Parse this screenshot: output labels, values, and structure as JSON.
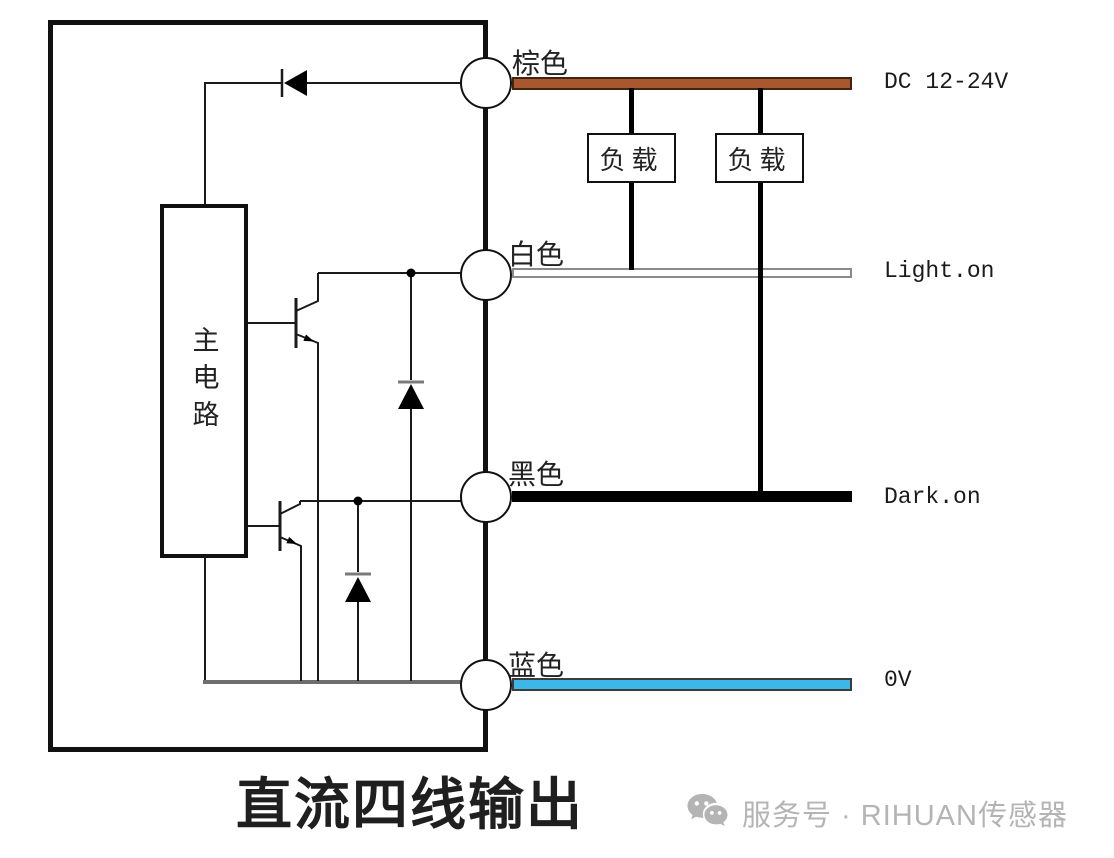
{
  "title": "直流四线输出",
  "sensor": {
    "main_circuit_label": "主电路"
  },
  "loads": [
    {
      "label": "负载"
    },
    {
      "label": "负载"
    }
  ],
  "terminals": [
    {
      "id": "brown",
      "label": "棕色",
      "line_label": "DC 12-24V",
      "wire_color": "#a8572e"
    },
    {
      "id": "white",
      "label": "白色",
      "line_label": "Light.on",
      "wire_color": "#ffffff"
    },
    {
      "id": "black",
      "label": "黑色",
      "line_label": "Dark.on",
      "wire_color": "#000000"
    },
    {
      "id": "blue",
      "label": "蓝色",
      "line_label": "0V",
      "wire_color": "#3db6e8"
    }
  ],
  "components": {
    "transistor_icons": [
      "npn-transistor-upper",
      "npn-transistor-lower"
    ],
    "diode_icons": [
      "reverse-protection-diode",
      "clamp-diode-upper",
      "clamp-diode-lower"
    ]
  },
  "watermark": {
    "icon": "wechat-icon",
    "text": "服务号 · RIHUAN传感器",
    "color": "#b4b4b4"
  }
}
